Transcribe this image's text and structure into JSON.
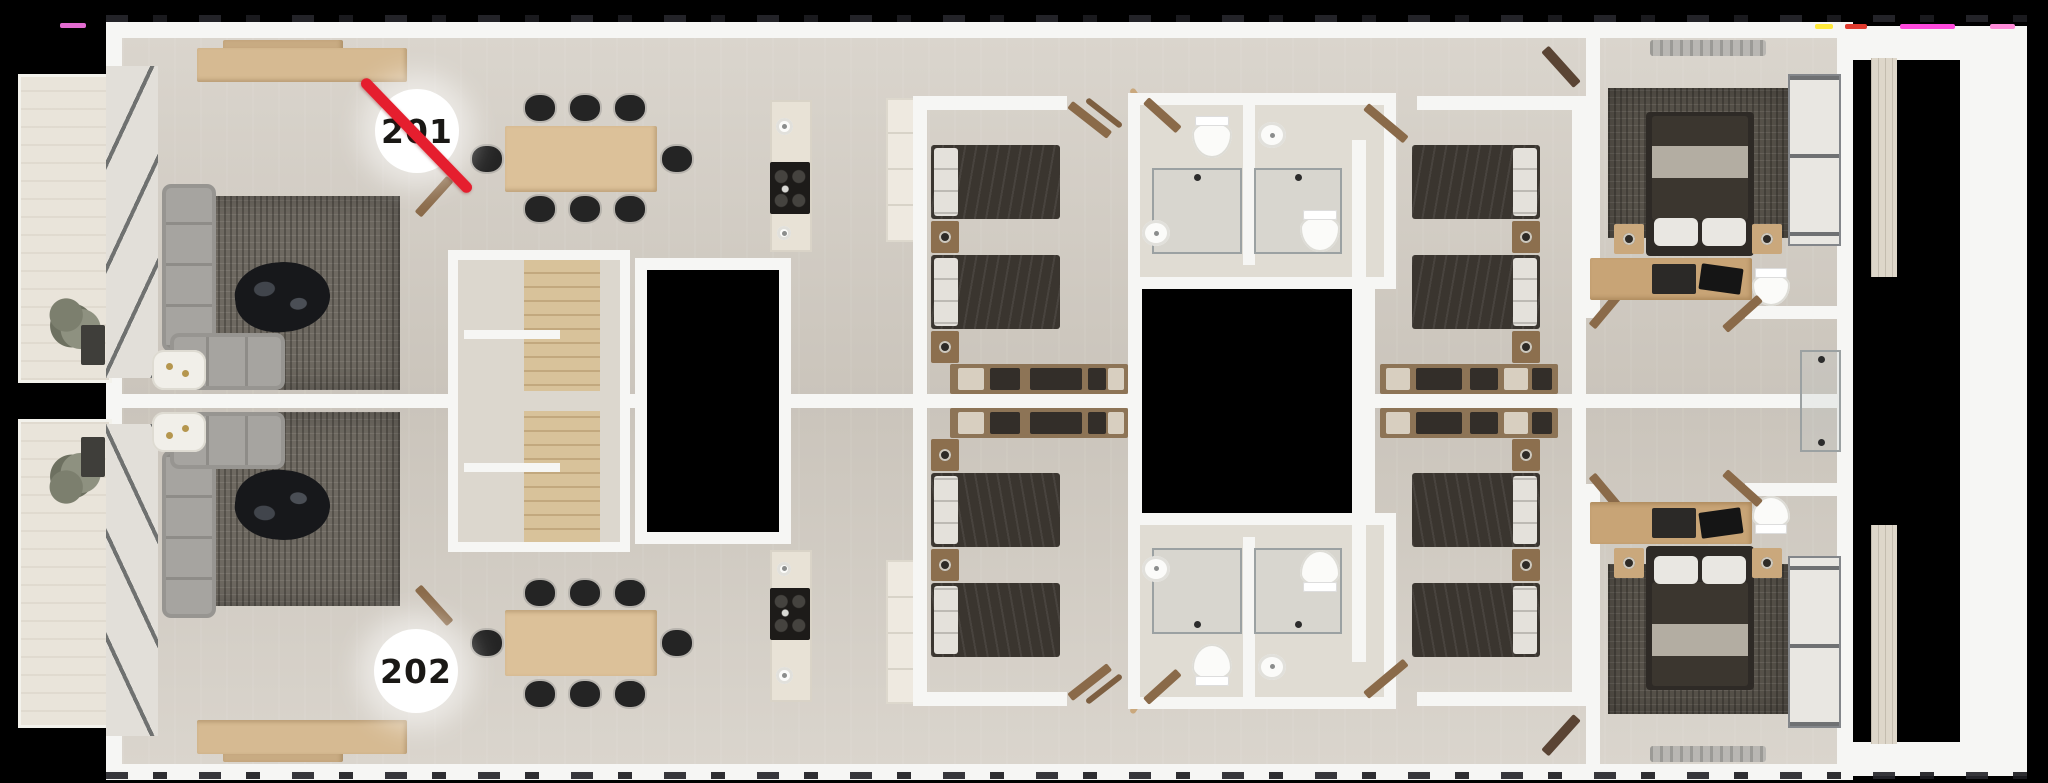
{
  "canvas": {
    "width": 2048,
    "height": 783,
    "background": "#000000"
  },
  "units": [
    {
      "label": "201",
      "struck_through": true
    },
    {
      "label": "202",
      "struck_through": false
    }
  ],
  "colors": {
    "strike_red": "#e51e2e",
    "badge_background": "#ffffff",
    "badge_text": "#1a1815",
    "walls": "#f6f6f4",
    "floor": "#d6d1c8",
    "wood": "#d6ba92",
    "sofa": "#a6a4a0",
    "bedding": "#3a352f",
    "rug": "#6e6961",
    "balcony_tile": "#e9e4da"
  }
}
